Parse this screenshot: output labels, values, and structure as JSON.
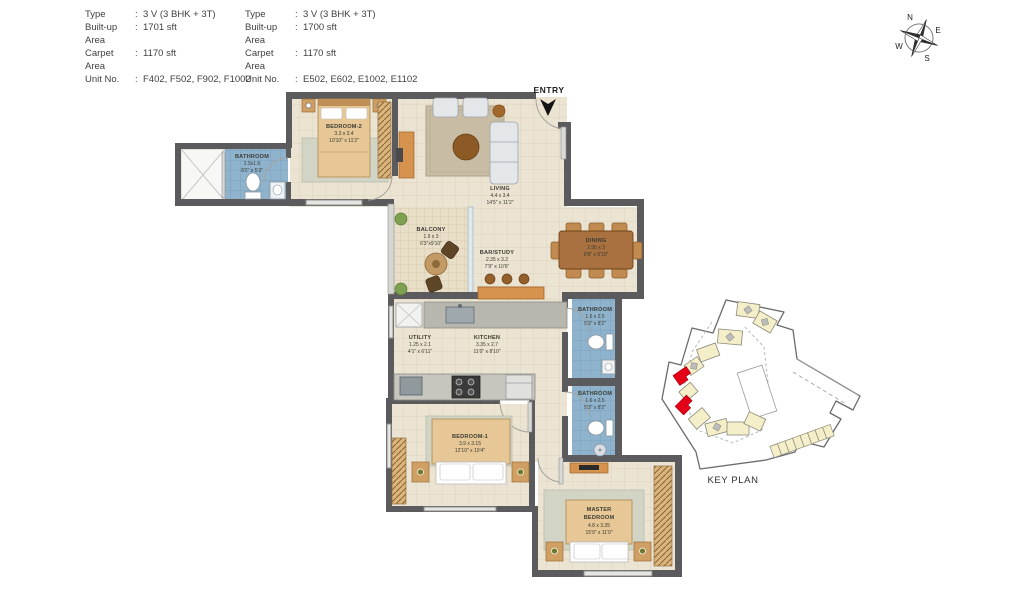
{
  "spec_tables": {
    "colon": ":",
    "tables": [
      {
        "rows": [
          {
            "label": "Type",
            "value": "3 V (3 BHK + 3T)"
          },
          {
            "label": "Built-up Area",
            "value": "1701 sft"
          },
          {
            "label": "Carpet Area",
            "value": "1170 sft"
          },
          {
            "label": "Unit No.",
            "value": "F402, F502, F902, F1002"
          }
        ]
      },
      {
        "rows": [
          {
            "label": "Type",
            "value": "3 V (3 BHK + 3T)"
          },
          {
            "label": "Built-up Area",
            "value": "1700 sft"
          },
          {
            "label": "Carpet Area",
            "value": "1170 sft"
          },
          {
            "label": "Unit No.",
            "value": "E502, E602, E1002, E1102"
          }
        ]
      }
    ]
  },
  "compass": {
    "n": "N",
    "e": "E",
    "s": "S",
    "w": "W"
  },
  "entry": {
    "label": "ENTRY"
  },
  "key_plan": {
    "label": "KEY PLAN"
  },
  "rooms": {
    "bathroom_top": {
      "name": "BATHROOM",
      "metric": "2.5x1.6",
      "imperial": "8'2\" x 5'3\""
    },
    "bedroom2": {
      "name": "BEDROOM-2",
      "metric": "3.3 x 3.4",
      "imperial": "10'10\" x 11'2\""
    },
    "living": {
      "name": "LIVING",
      "metric": "4.4 x 3.4",
      "imperial": "14'5\" x 11'2\""
    },
    "balcony": {
      "name": "BALCONY",
      "metric": "1.9 x 3",
      "imperial": "6'3\"x9'10\""
    },
    "bar_study": {
      "name": "BAR/STUDY",
      "metric": "2.35 x 3.2",
      "imperial": "7'9\" x 10'6\""
    },
    "dining": {
      "name": "DINING",
      "metric": "2.95 x 3",
      "imperial": "9'8\" x 9'10\""
    },
    "utility": {
      "name": "UTILITY",
      "metric": "1.25 x 2.1",
      "imperial": "4'1\" x 6'11\""
    },
    "kitchen": {
      "name": "KITCHEN",
      "metric": "3.35 x 2.7",
      "imperial": "11'0\" x 8'10\""
    },
    "bathroom_mid": {
      "name": "BATHROOM",
      "metric": "1.6 x 2.5",
      "imperial": "5'3\" x 8'2\""
    },
    "bathroom_low": {
      "name": "BATHROOM",
      "metric": "1.6 x 2.5",
      "imperial": "5'3\" x 8'2\""
    },
    "bedroom1": {
      "name": "BEDROOM-1",
      "metric": "3.9 x 3.15",
      "imperial": "12'10\" x 10'4\""
    },
    "master": {
      "name_line1": "MASTER",
      "name_line2": "BEDROOM",
      "metric": "4.8 x 3.35",
      "imperial": "15'9\" x 11'0\""
    }
  },
  "colors": {
    "wall": "#5b5b5d",
    "floor": "#ece4d3",
    "bathroom_tile": "#8fb3cd",
    "keyplan_highlight": "#e60017"
  }
}
